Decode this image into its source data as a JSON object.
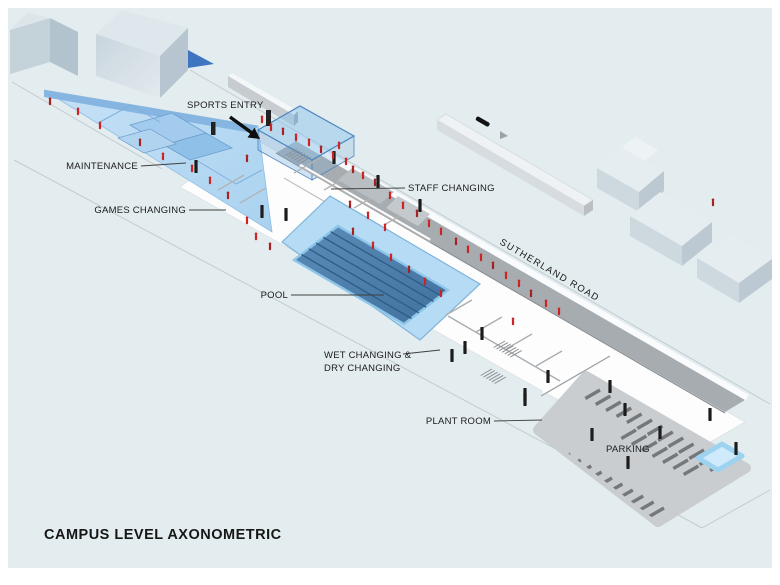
{
  "title": "CAMPUS LEVEL AXONOMETRIC",
  "labels": {
    "sports_entry": "SPORTS ENTRY",
    "maintenance": "MAINTENANCE",
    "games_changing": "GAMES CHANGING",
    "staff_changing": "STAFF CHANGING",
    "pool": "POOL",
    "sutherland_road": "SUTHERLAND ROAD",
    "wet_dry_changing": {
      "line1": "WET CHANGING &",
      "line2": "DRY CHANGING"
    },
    "plant_room": "PLANT ROOM",
    "parking": "PARKING"
  },
  "colors": {
    "canvas_bg": "#e3ecef",
    "pool_water": "#4d7fa9",
    "pool_lane": "#2f5d86",
    "deck_blue": "#b5dcf4",
    "wedge_blue": "#b7d9f2",
    "roof_band_gray": "#a7acb0",
    "parking_lot_gray": "#c9cdd0",
    "parking_stripe": "#74787b",
    "people_red": "#cc2222",
    "glass_blue": "#4e86c0",
    "shadow_blue": "#3f74c1",
    "label_text": "#1c1c1c"
  }
}
